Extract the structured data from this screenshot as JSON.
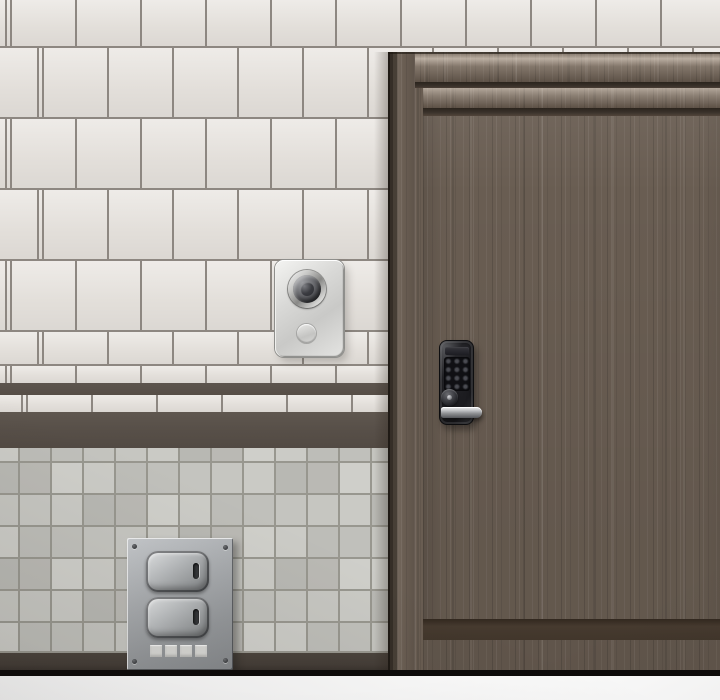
{
  "meta": {
    "width_px": 720,
    "height_px": 700
  },
  "palette": {
    "tile_white": "#e7e3de",
    "tile_grout": "#8d8781",
    "stripe_thin": "#564e47",
    "stripe_thick": "#585049",
    "gray_grout": "#98978f",
    "baseboard": "#453e38",
    "bottom_bar": "#0d0b0a",
    "bottom_margin": "#fcfcfc",
    "door_wood": "#695d52",
    "door_groove": "#3a322b",
    "door_bottom_band": "#463a2f",
    "lock_body": "#1b1b1f",
    "handle_metal": "#c3c5c8",
    "bell_plate": "#d9d9d7",
    "switch_plate": "#a8abae"
  },
  "gray_tile_shades": [
    "#cbcbc6",
    "#c0c0bb",
    "#c6c6c1",
    "#b8b8b3",
    "#cfcfca",
    "#bdbdb8",
    "#c4c4bf",
    "#cacac5",
    "#bab9b4"
  ],
  "scene": {
    "objects": {
      "door": {
        "label": "wooden door"
      },
      "lock": {
        "label": "digital keypad lock",
        "keypad_label": "keypad",
        "keypad_rows": 4,
        "keypad_cols": 3,
        "cylinder_label": "key cylinder",
        "display_label": "lock display"
      },
      "handle": {
        "label": "lever handle"
      },
      "doorbell": {
        "label": "doorbell plate",
        "button_label": "doorbell button",
        "small_label": "small round button"
      },
      "switch_panel": {
        "label": "metal switch panel",
        "top_label": "top rocker switch",
        "bottom_label": "bottom rocker switch",
        "indicator_count": 4
      }
    }
  }
}
